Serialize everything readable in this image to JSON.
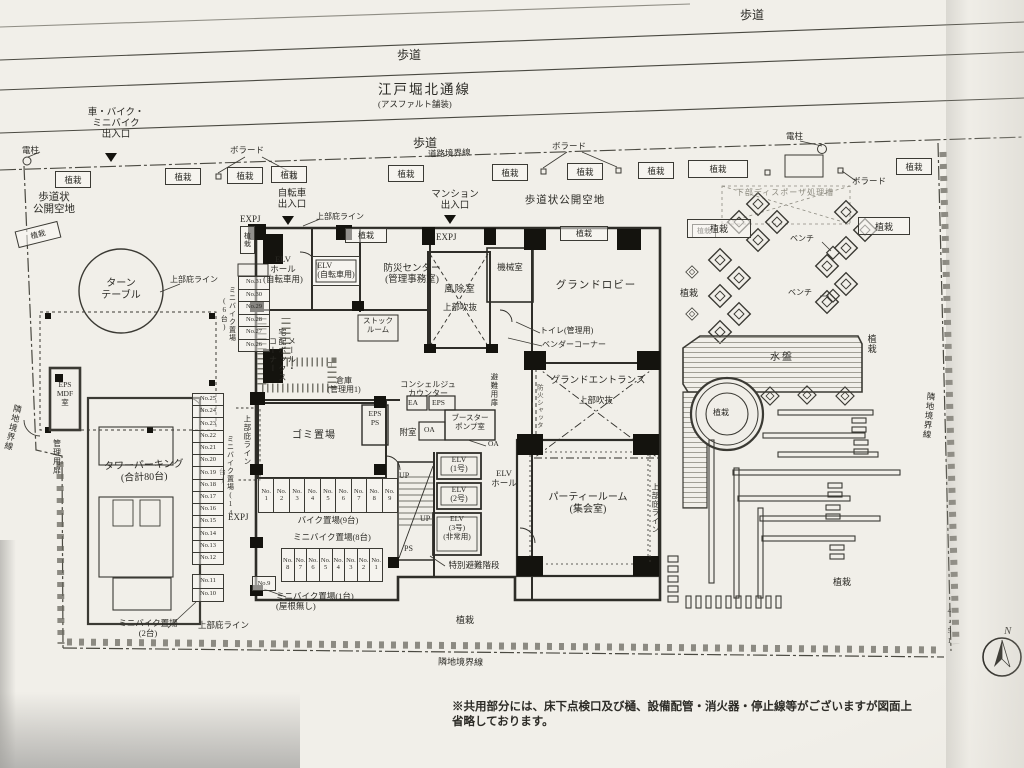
{
  "common": {
    "planting": "植栽",
    "bench": "ベンチ",
    "bollard": "ボラード",
    "pole": "電柱",
    "expj": "EXPJ",
    "canopy_line": "上部庇ライン",
    "up": "UP",
    "ps": "PS",
    "oa": "OA",
    "ea": "EA",
    "eps": "EPS",
    "sidewalk": "歩道",
    "boundary_neighbor": "隣地境界線",
    "boundary_road": "道路境界線",
    "open_space": "歩道状公開空地"
  },
  "street": {
    "road_name": "江戸堀北通線",
    "road_surface": "(アスファルト舗装)",
    "vehicle_entrance": "車・バイク・\nミニバイク\n出入口",
    "bicycle_entrance": "自転車\n出入口",
    "mansion_entrance": "マンション\n出入口"
  },
  "site": {
    "open_space_left": "歩道状\n公開空地",
    "disposer": "下部ディスポーザ処理槽",
    "water_basin": "水盤",
    "compass_n": "N",
    "compass_value": "4.51",
    "note": "※共用部分には、床下点検口及び樋、設備配管・消火器・停止線等がございますが図面上省略しております。"
  },
  "rooms": {
    "turntable": "ターン\nテーブル",
    "tower_parking": "タワーパーキング\n(合計80台)",
    "eps_mdf": "EPS\nMDF\n室",
    "admin_door": "管理用扉",
    "elv_hall_bike": "ELV\nホール\n(自転車用)",
    "elv_bike": "ELV\n(自転車用)",
    "bosai": "防災センター\n(管理事務室)",
    "windbreak": "風除室",
    "windbreak_sub": "上部吹抜",
    "machine": "機械室",
    "grand_lobby": "グランドロビー",
    "toilet": "トイレ(管理用)",
    "vendor": "ベンダーコーナー",
    "evac_door": "避難用扉",
    "grand_entrance": "グランドエントランス",
    "grand_entrance_sub": "上部吹抜",
    "fire_shutter": "防火シャッター",
    "mailbox": "メール・\n宅配ボックス\nコーナー",
    "stock_room": "ストック\nルーム",
    "storage": "倉庫\n(管理用1)",
    "concierge": "コンシェルジュ\nカウンター",
    "garbage": "ゴミ置場",
    "eps_ps": "EPS\nPS",
    "fuzoku": "附室",
    "booster": "ブースター\nポンプ室",
    "elv1": "ELV\n(1号)",
    "elv2": "ELV\n(2号)",
    "elv3": "ELV\n(3号)\n(非常用)",
    "elv_hall": "ELV\nホール",
    "special_stairs": "特別避難階段",
    "party": "パーティールーム\n(集会室)",
    "bike_area": "バイク置場(9台)",
    "mini8": "ミニバイク置場(8台)",
    "mini14": "ミニバイク置場(14台)",
    "mini6": "ミニバイク置場(6台)",
    "mini2": "ミニバイク置場\n(2台)",
    "mini1": "ミニバイク置場(1台)\n(屋根無し)"
  },
  "stalls": {
    "mini_left": [
      "No.31",
      "No.30",
      "No.29",
      "No.28",
      "No.27",
      "No.26"
    ],
    "mini_col": [
      "No.25",
      "No.24",
      "No.23",
      "No.22",
      "No.21",
      "No.20",
      "No.19",
      "No.18",
      "No.17",
      "No.16",
      "No.15",
      "No.14",
      "No.13",
      "No.12"
    ],
    "mini_col2": [
      "No.11",
      "No.10"
    ],
    "no9": "No.9",
    "bike_row": [
      "No.\n1",
      "No.\n2",
      "No.\n3",
      "No.\n4",
      "No.\n5",
      "No.\n6",
      "No.\n7",
      "No.\n8",
      "No.\n9"
    ],
    "mini_row": [
      "No.\n8",
      "No.\n7",
      "No.\n6",
      "No.\n5",
      "No.\n4",
      "No.\n3",
      "No.\n2",
      "No.\n1"
    ]
  }
}
